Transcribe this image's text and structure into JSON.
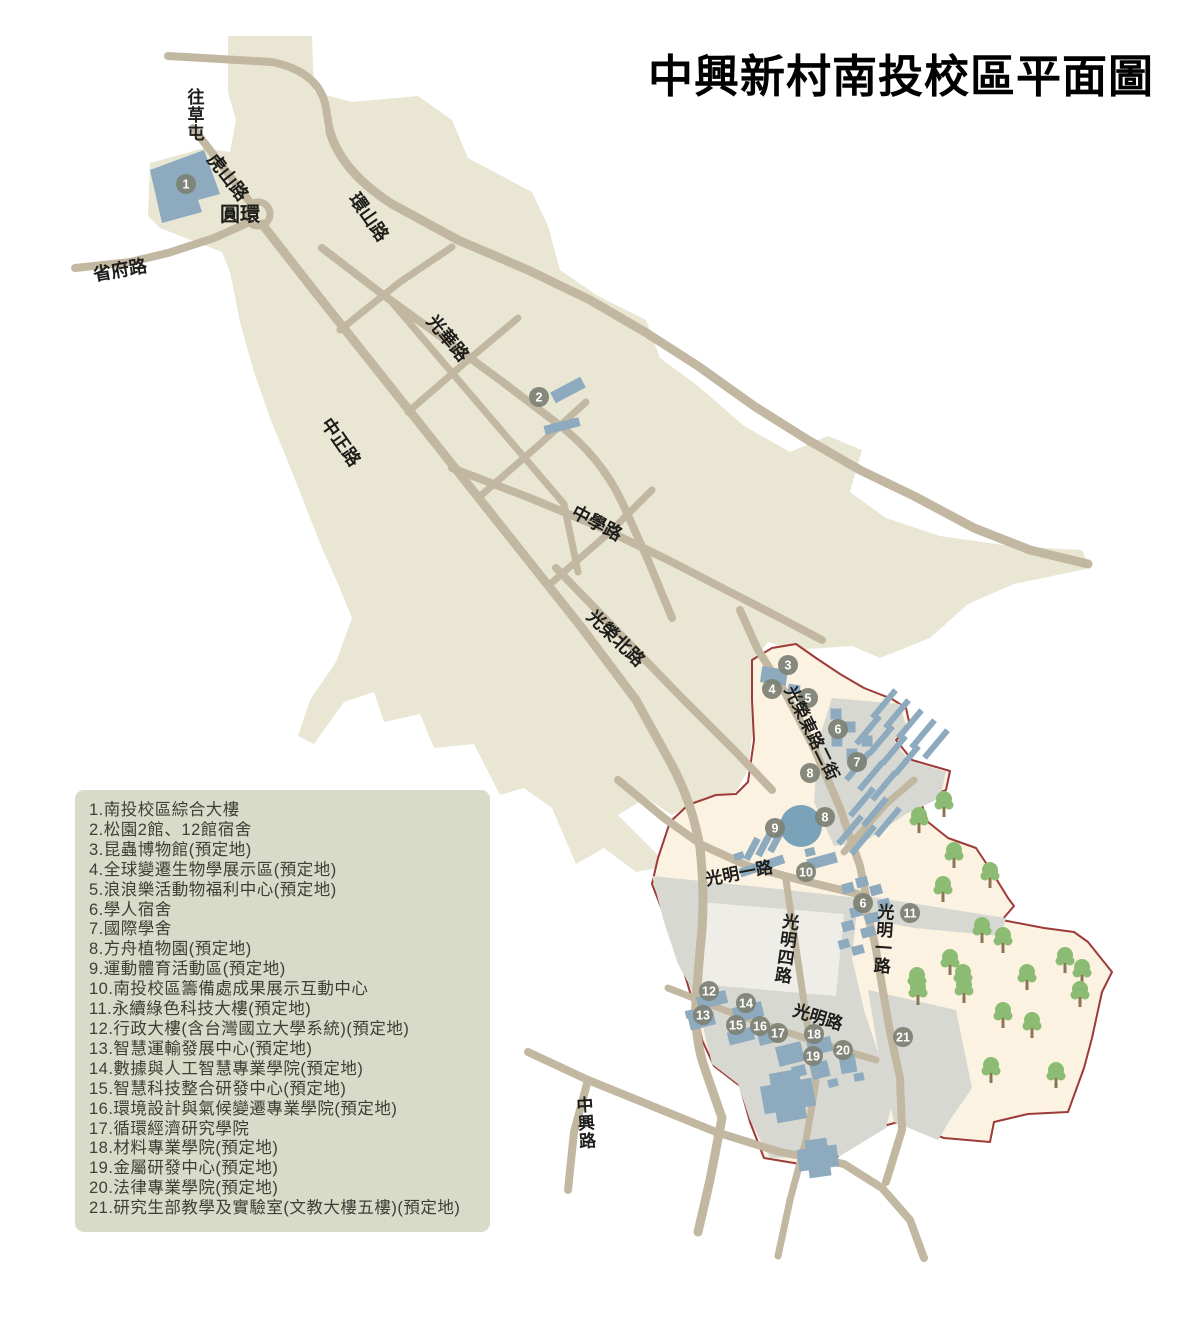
{
  "title": "中興新村南投校區平面圖",
  "colors": {
    "village": "#e9e6d3",
    "campus_fill": "#fcf2e1",
    "campus_border": "#9d3b38",
    "zone": "#d7d8d2",
    "plaza": "#eeede7",
    "road": "#c2b7a1",
    "building": "#8daabe",
    "water": "#7aa2b8",
    "tree_leaf": "#8cbc74",
    "tree_trunk": "#8c7555",
    "marker": "#7d8174",
    "marker_text": "#ffffff",
    "label_text": "#1d1d1b",
    "legend_bg": "#d9dbc9"
  },
  "legend": {
    "items": [
      {
        "num": "1",
        "label": "南投校區綜合大樓"
      },
      {
        "num": "2",
        "label": "松園2館、12館宿舍"
      },
      {
        "num": "3",
        "label": "昆蟲博物館(預定地)"
      },
      {
        "num": "4",
        "label": "全球變遷生物學展示區(預定地)"
      },
      {
        "num": "5",
        "label": "浪浪樂活動物福利中心(預定地)"
      },
      {
        "num": "6",
        "label": "學人宿舍"
      },
      {
        "num": "7",
        "label": "國際學舍"
      },
      {
        "num": "8",
        "label": "方舟植物園(預定地)"
      },
      {
        "num": "9",
        "label": "運動體育活動區(預定地)"
      },
      {
        "num": "10",
        "label": "南投校區籌備處成果展示互動中心"
      },
      {
        "num": "11",
        "label": "永續綠色科技大樓(預定地)"
      },
      {
        "num": "12",
        "label": "行政大樓(含台灣國立大學系統)(預定地)"
      },
      {
        "num": "13",
        "label": "智慧運輸發展中心(預定地)"
      },
      {
        "num": "14",
        "label": "數據與人工智慧專業學院(預定地)"
      },
      {
        "num": "15",
        "label": "智慧科技整合研發中心(預定地)"
      },
      {
        "num": "16",
        "label": "環境設計與氣候變遷專業學院(預定地)"
      },
      {
        "num": "17",
        "label": "循環經濟研究學院"
      },
      {
        "num": "18",
        "label": "材料專業學院(預定地)"
      },
      {
        "num": "19",
        "label": "金屬研發中心(預定地)"
      },
      {
        "num": "20",
        "label": "法律專業學院(預定地)"
      },
      {
        "num": "21",
        "label": "研究生部教學及實驗室(文教大樓五樓)(預定地)"
      }
    ]
  },
  "map": {
    "village_path": "M228,36 L312,36 L314,92 L352,102 L418,96 L452,120 L468,158 L532,192 L548,226 L560,270 L598,296 L646,320 L660,358 L698,386 L744,426 L790,452 L828,436 L862,450 L850,492 L886,518 L940,536 L1010,546 L1082,550 L1090,568 L1014,584 L968,604 L930,638 L880,658 L852,646 L794,650 L768,642 L754,660 L754,720 L748,770 L736,792 L704,798 L672,815 L646,798 L618,815 L648,845 L668,866 L636,872 L604,848 L576,864 L552,808 L524,788 L500,795 L474,744 L434,748 L420,714 L384,722 L374,692 L344,702 L314,744 L298,736 L310,700 L336,662 L352,618 L338,584 L322,548 L305,505 L288,462 L270,418 L254,372 L240,322 L230,272 L222,252 L196,242 L160,228 L148,216 L150,163 L204,148 L230,152 L236,120 L228,92 Z",
    "campus_path": "M752,660 L772,648 L796,644 L816,658 L840,674 L864,688 L892,699 L906,708 L910,726 L896,740 L912,760 L950,771 L946,790 L920,800 L928,822 L948,838 L976,848 L992,872 L1008,898 L1014,906 L1002,920 L1044,928 L1074,932 L1088,942 L1112,972 L1102,992 L1092,1038 L1084,1068 L1068,1112 L1028,1114 L994,1122 L990,1142 L944,1138 L898,1122 L862,1132 L834,1160 L800,1164 L764,1158 L750,1122 L740,1086 L714,1066 L702,1040 L696,1012 L684,972 L670,930 L652,884 L658,858 L670,822 L688,805 L716,795 L736,794 L748,782 L754,740 L752,700 Z",
    "zones": [
      "M832,698 L900,704 L906,726 L894,740 L908,760 L946,772 L940,798 L906,814 L864,842 L834,846 L814,802 L818,742 Z",
      "M866,896 L1006,918 L1001,936 L914,928 L872,920 Z",
      "M652,876 L788,890 L858,898 L852,958 L864,1010 L880,1058 L892,1104 L886,1128 L840,1156 L770,1158 L750,1120 L738,1084 L712,1064 L700,1014 L690,986 L678,964 L664,922 Z",
      "M868,990 L956,1010 L972,1088 L950,1120 L938,1140 L894,1122 L878,1050 Z"
    ],
    "plaza_path": "M700,902 L844,914 L836,996 L698,984 Z",
    "roads": [
      [
        "M168,56 L272,62 Q320,72 326,108 L330,132",
        8
      ],
      [
        "M330,132 Q342,172 392,204 L458,240 L528,270 L590,300 L645,332 L698,366 L754,406 L808,440 L860,470 L914,496 L974,528 L1030,550 L1088,564",
        9
      ],
      [
        "M193,128 L256,210",
        8
      ],
      [
        "M75,268 L130,262 L168,253 L214,238 L250,222",
        8
      ],
      [
        "M262,224 L312,288 L366,356 L420,424 L474,492 L528,560 L582,628 L636,700 L668,758 Q692,800 700,848 Q706,902 700,950 L696,1000 Q694,1040 706,1072 L722,1118 L710,1180 L698,1232",
        9
      ],
      [
        "M322,248 L382,294 L440,336 L500,380 L558,424 Q600,456 622,502 L648,560 L672,618",
        8
      ],
      [
        "M556,568 L620,634 L682,698 L736,752 L772,790",
        8
      ],
      [
        "M390,300 L448,368 L506,436 L564,504 L578,572",
        7
      ],
      [
        "M452,468 L530,498 L602,528 L668,560 L734,594 L788,622 L822,640",
        8
      ],
      [
        "M740,610 L758,650 L786,694 L814,748 L840,808 L860,866 L866,896",
        8
      ],
      [
        "M618,780 L664,818 L702,845 L748,866 L800,880 L858,894 Q872,920 878,962 L890,1032 L900,1078 L902,1130 L886,1182",
        8
      ],
      [
        "M786,880 L796,948 L806,1016 L816,1082 L806,1140 L790,1200 L778,1256",
        7
      ],
      [
        "M668,988 L724,1010 L780,1030 L836,1048 L876,1060",
        7
      ],
      [
        "M844,852 L886,804 L914,780",
        7
      ],
      [
        "M528,1052 L588,1080 L652,1106 L716,1132 L780,1152 L844,1164 L882,1188 L910,1220 L924,1258",
        8
      ],
      [
        "M588,1080 L574,1132 L568,1190",
        8
      ],
      [
        "M340,330 L400,282 L452,247",
        7
      ],
      [
        "M408,412 L468,360 L518,318",
        7
      ],
      [
        "M478,498 L540,444 L586,402",
        7
      ],
      [
        "M548,586 L610,532 L652,490",
        7
      ]
    ],
    "roundabout": {
      "x": 258,
      "y": 214,
      "r": 12
    },
    "pond": {
      "x": 801,
      "y": 826,
      "r": 21
    },
    "buildings": {
      "poly": "M150,170 L204,150 L220,194 L198,200 L202,212 L162,223 Z",
      "bar_size": [
        36,
        6
      ],
      "bar_rot": -50,
      "bars": [
        [
          884,
          704
        ],
        [
          897,
          714
        ],
        [
          910,
          724
        ],
        [
          923,
          734
        ],
        [
          936,
          744
        ],
        [
          868,
          730
        ],
        [
          881,
          740
        ],
        [
          894,
          750
        ],
        [
          907,
          760
        ],
        [
          858,
          766
        ],
        [
          871,
          776
        ],
        [
          884,
          786
        ],
        [
          862,
          802
        ],
        [
          875,
          812
        ],
        [
          888,
          822
        ],
        [
          850,
          830
        ],
        [
          863,
          840
        ]
      ],
      "rects": [
        [
          568,
          390,
          34,
          12,
          -28
        ],
        [
          562,
          426,
          36,
          9,
          -14
        ],
        [
          774,
          676,
          26,
          16,
          8
        ],
        [
          794,
          689,
          12,
          9,
          8
        ],
        [
          836,
          714,
          11,
          11,
          0
        ],
        [
          850,
          727,
          11,
          11,
          0
        ],
        [
          837,
          741,
          11,
          11,
          0
        ],
        [
          852,
          754,
          11,
          11,
          0
        ],
        [
          867,
          741,
          11,
          11,
          0
        ],
        [
          752,
          849,
          24,
          7,
          -62
        ],
        [
          764,
          845,
          24,
          7,
          -62
        ],
        [
          776,
          841,
          24,
          7,
          -62
        ],
        [
          762,
          866,
          46,
          9,
          -18
        ],
        [
          739,
          856,
          10,
          7,
          -18
        ],
        [
          822,
          861,
          30,
          11,
          -15
        ],
        [
          810,
          852,
          10,
          8,
          -15
        ],
        [
          848,
          888,
          12,
          10,
          -15
        ],
        [
          862,
          882,
          12,
          10,
          -15
        ],
        [
          876,
          890,
          12,
          10,
          -15
        ],
        [
          884,
          904,
          12,
          10,
          -15
        ],
        [
          872,
          918,
          14,
          10,
          -15
        ],
        [
          856,
          912,
          12,
          10,
          -15
        ],
        [
          848,
          926,
          12,
          10,
          -15
        ],
        [
          868,
          932,
          14,
          10,
          -15
        ],
        [
          844,
          944,
          11,
          9,
          -15
        ],
        [
          858,
          950,
          12,
          9,
          -15
        ],
        [
          712,
          1000,
          30,
          13,
          -14
        ],
        [
          702,
          1021,
          26,
          13,
          -14
        ],
        [
          690,
          1014,
          9,
          8,
          -14
        ],
        [
          748,
          1012,
          30,
          15,
          -14
        ],
        [
          741,
          1036,
          26,
          13,
          -14
        ],
        [
          769,
          1036,
          22,
          15,
          -14
        ],
        [
          790,
          1054,
          26,
          20,
          -14
        ],
        [
          799,
          1071,
          14,
          11,
          -14
        ],
        [
          820,
          1046,
          24,
          15,
          -14
        ],
        [
          820,
          1070,
          18,
          16,
          -14
        ],
        [
          833,
          1083,
          10,
          8,
          -14
        ],
        [
          848,
          1064,
          16,
          18,
          -10
        ],
        [
          859,
          1077,
          10,
          8,
          -10
        ],
        [
          788,
          1096,
          52,
          28,
          -10
        ],
        [
          788,
          1096,
          30,
          50,
          -10
        ],
        [
          818,
          1158,
          40,
          22,
          -8
        ],
        [
          818,
          1158,
          22,
          38,
          -8
        ]
      ]
    },
    "trees": [
      [
        944,
        807
      ],
      [
        919,
        823
      ],
      [
        954,
        858
      ],
      [
        990,
        878
      ],
      [
        943,
        892
      ],
      [
        982,
        933
      ],
      [
        1003,
        943
      ],
      [
        950,
        965
      ],
      [
        917,
        983
      ],
      [
        963,
        980
      ],
      [
        1027,
        980
      ],
      [
        1065,
        963
      ],
      [
        1082,
        975
      ],
      [
        918,
        995
      ],
      [
        964,
        993
      ],
      [
        1003,
        1018
      ],
      [
        1032,
        1028
      ],
      [
        1080,
        997
      ],
      [
        991,
        1073
      ],
      [
        1056,
        1078
      ]
    ],
    "markers": [
      [
        1,
        186,
        184
      ],
      [
        2,
        539,
        397
      ],
      [
        3,
        788,
        665
      ],
      [
        4,
        772,
        689
      ],
      [
        5,
        808,
        698
      ],
      [
        6,
        838,
        729
      ],
      [
        7,
        857,
        762
      ],
      [
        8,
        810,
        773
      ],
      [
        8,
        825,
        817
      ],
      [
        9,
        775,
        828
      ],
      [
        10,
        806,
        872
      ],
      [
        6,
        863,
        903
      ],
      [
        11,
        910,
        913
      ],
      [
        12,
        709,
        991
      ],
      [
        13,
        703,
        1015
      ],
      [
        14,
        746,
        1003
      ],
      [
        15,
        736,
        1025
      ],
      [
        16,
        760,
        1026
      ],
      [
        17,
        778,
        1033
      ],
      [
        18,
        814,
        1034
      ],
      [
        19,
        813,
        1056
      ],
      [
        20,
        843,
        1050
      ],
      [
        21,
        903,
        1037
      ]
    ],
    "labels": [
      {
        "t": "往草屯",
        "x": 196,
        "y": 97,
        "rot": 0,
        "v": 1,
        "s": 17
      },
      {
        "t": "虎山路",
        "x": 228,
        "y": 177,
        "rot": 52,
        "v": 0,
        "s": 18
      },
      {
        "t": "圓環",
        "x": 240,
        "y": 214,
        "rot": 0,
        "v": 0,
        "s": 20
      },
      {
        "t": "省府路",
        "x": 120,
        "y": 270,
        "rot": -10,
        "v": 0,
        "s": 18
      },
      {
        "t": "環山路",
        "x": 369,
        "y": 217,
        "rot": 55,
        "v": 0,
        "s": 18
      },
      {
        "t": "光華路",
        "x": 448,
        "y": 338,
        "rot": 50,
        "v": 0,
        "s": 18
      },
      {
        "t": "中正路",
        "x": 341,
        "y": 442,
        "rot": 55,
        "v": 0,
        "s": 18
      },
      {
        "t": "中學路",
        "x": 597,
        "y": 523,
        "rot": 28,
        "v": 0,
        "s": 18
      },
      {
        "t": "光榮北路",
        "x": 616,
        "y": 638,
        "rot": 44,
        "v": 0,
        "s": 18
      },
      {
        "t": "光榮東路二街",
        "x": 812,
        "y": 733,
        "rot": 64,
        "v": 0,
        "s": 17
      },
      {
        "t": "光明一路",
        "x": 739,
        "y": 873,
        "rot": -11,
        "v": 0,
        "s": 17
      },
      {
        "t": "光明四路",
        "x": 791,
        "y": 922,
        "rot": 8,
        "v": 1,
        "s": 17
      },
      {
        "t": "光明一路",
        "x": 886,
        "y": 912,
        "rot": 4,
        "v": 1,
        "s": 17
      },
      {
        "t": "光明路",
        "x": 818,
        "y": 1017,
        "rot": 17,
        "v": 0,
        "s": 17
      },
      {
        "t": "中興路",
        "x": 585,
        "y": 1105,
        "rot": -4,
        "v": 1,
        "s": 17
      }
    ]
  }
}
